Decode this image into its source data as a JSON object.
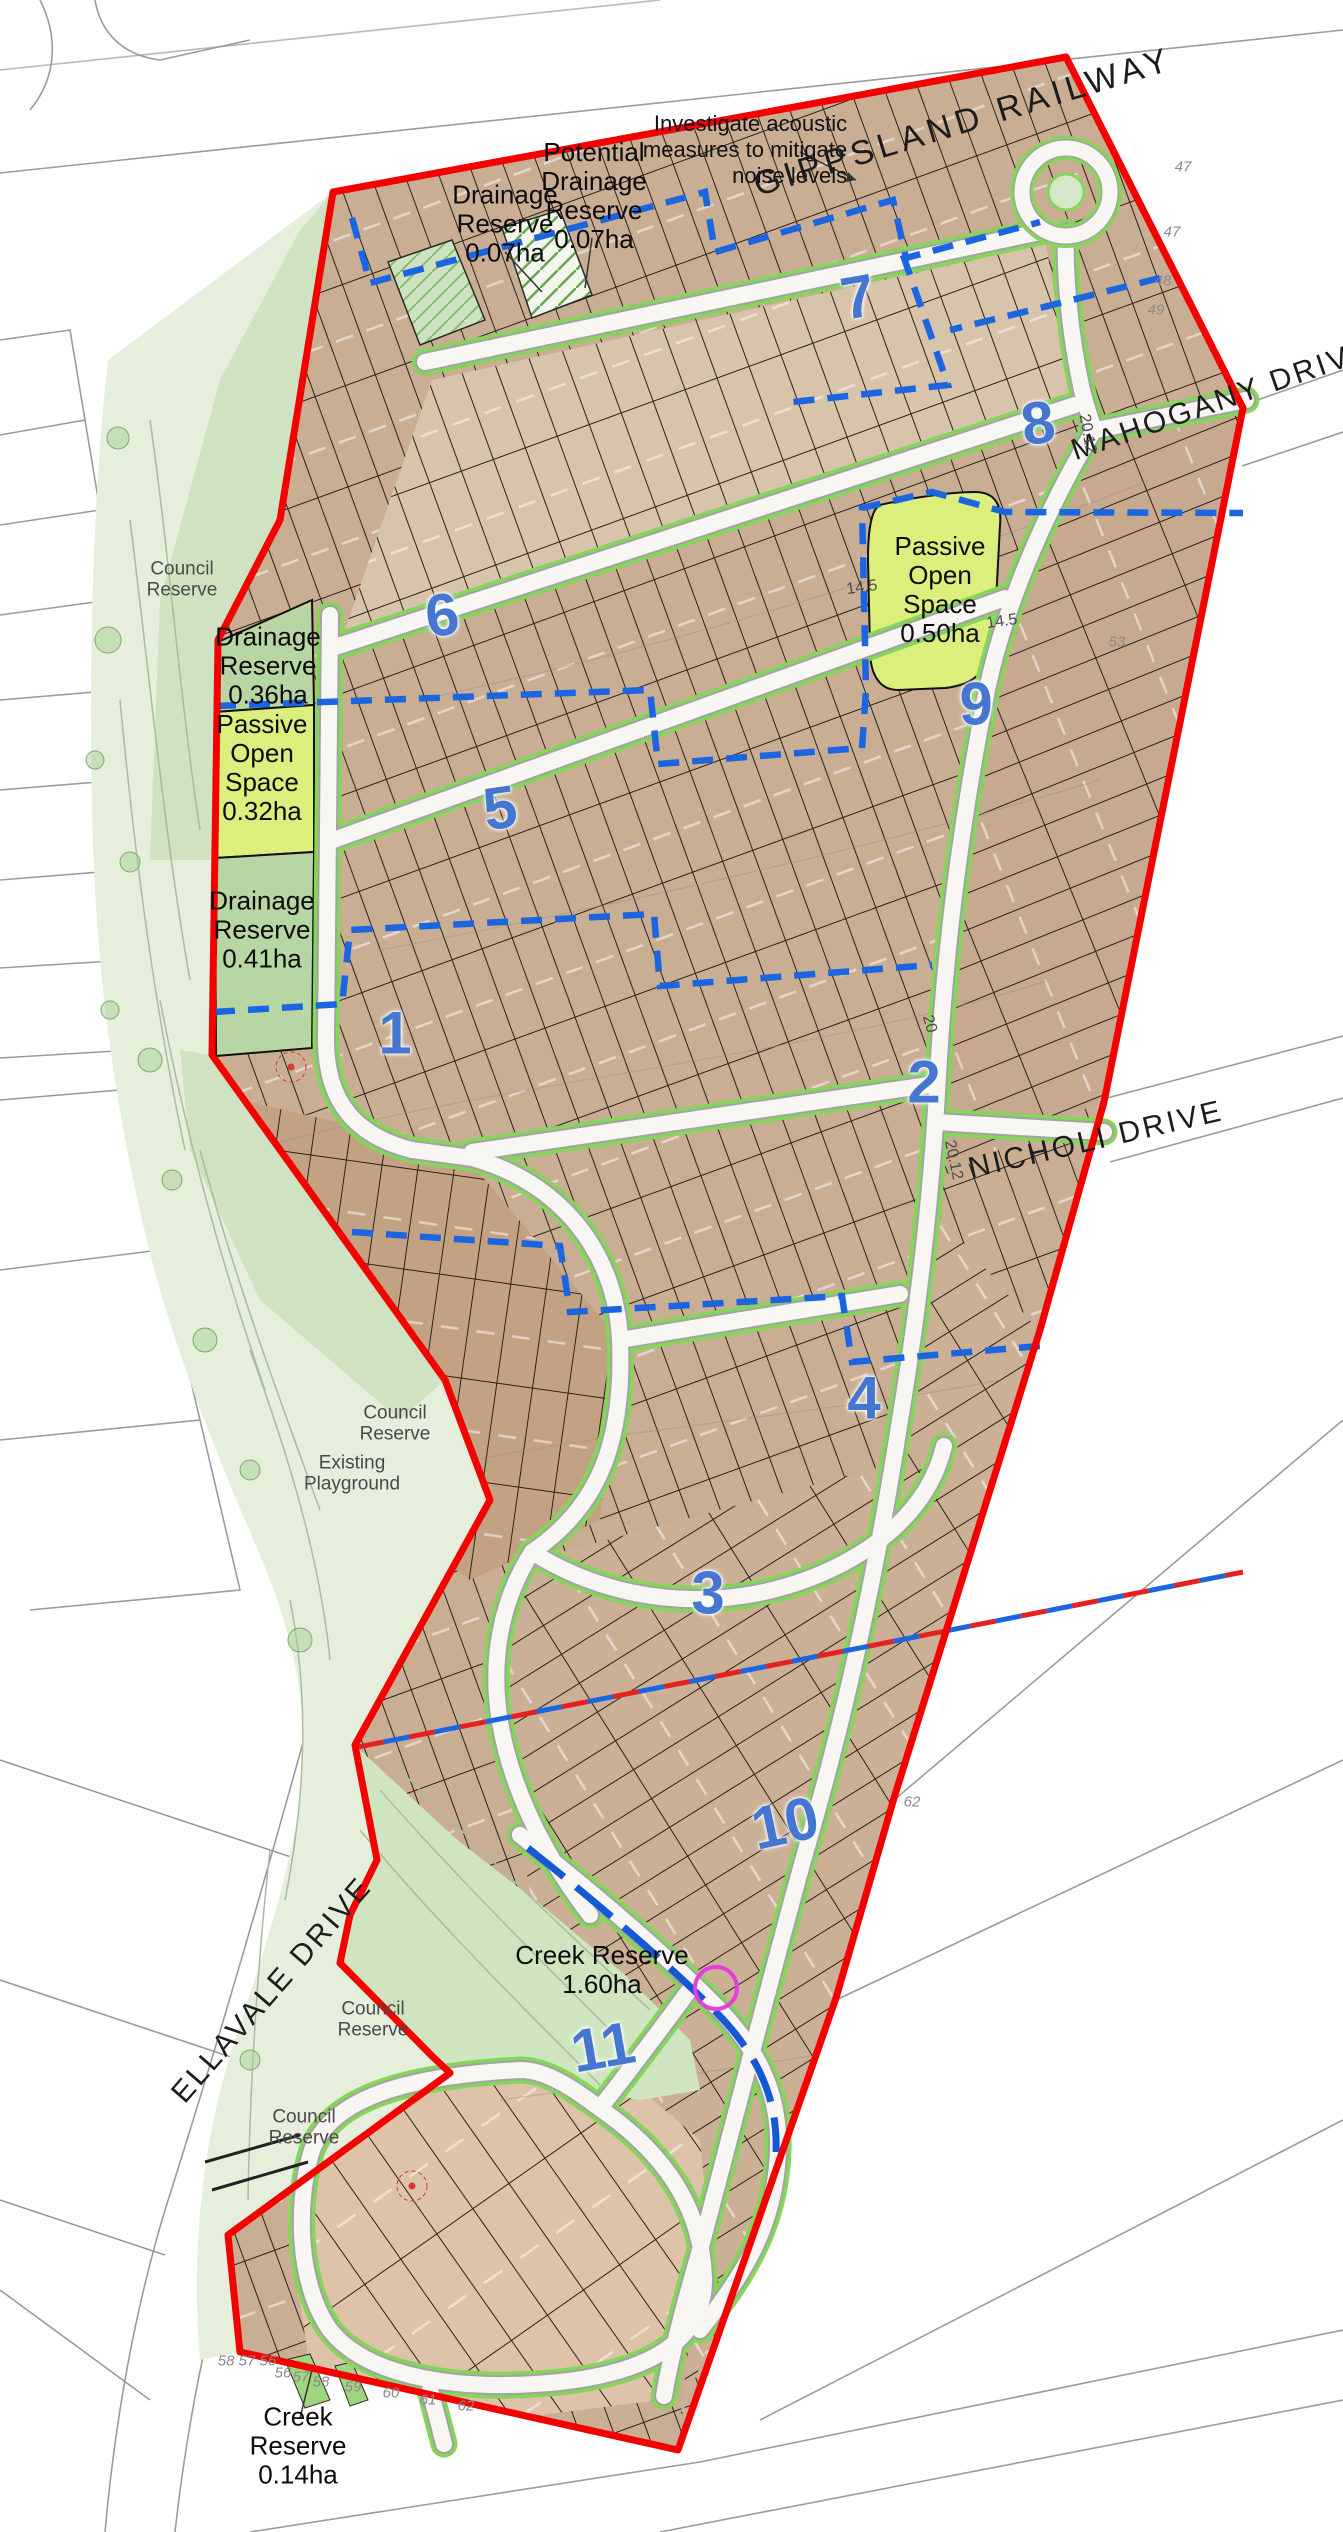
{
  "map": {
    "streets": {
      "gippsland_railway": "GIPPSLAND RAILWAY",
      "mahogany_drive": "MAHOGANY DRIVE",
      "nicholi_drive": "NICHOLI DRIVE",
      "ellavale_drive": "ELLAVALE DRIVE"
    },
    "annotations": {
      "acoustic_note": "Investigate acoustic\nmeasures to mitigate\nnoise levels"
    },
    "reserves": {
      "drainage_007": "Drainage\nReserve\n0.07ha",
      "potential_drainage_007": "Potential\nDrainage\nReserve\n0.07ha",
      "drainage_036": "Drainage\nReserve\n0.36ha",
      "passive_open_space_032": "Passive\nOpen\nSpace\n0.32ha",
      "drainage_041": "Drainage\nReserve\n0.41ha",
      "passive_open_space_050": "Passive\nOpen\nSpace\n0.50ha",
      "creek_160": "Creek Reserve\n1.60ha",
      "creek_014": "Creek\nReserve\n0.14ha",
      "council_nw": "Council\nReserve",
      "council_mid": "Council\nReserve",
      "existing_playground": "Existing\nPlayground",
      "council_ellavale": "Council\nReserve",
      "council_sw": "Council\nReserve"
    },
    "stages": {
      "s1": "1",
      "s2": "2",
      "s3": "3",
      "s4": "4",
      "s5": "5",
      "s6": "6",
      "s7": "7",
      "s8": "8",
      "s9": "9",
      "s10": "10",
      "s11": "11"
    },
    "survey_marks": {
      "m47a": "47",
      "m47b": "47",
      "m48": "48",
      "m49": "49",
      "m53": "53",
      "m62_right": "62",
      "cluster": "58 57 56",
      "m56": "56",
      "m57": "57",
      "m58": "58",
      "m59": "59",
      "m60": "60",
      "m61": "61",
      "m62_bottom": "62"
    },
    "dimensions": {
      "d145a": "14.5",
      "d145b": "14.5",
      "d2012a": "20.12",
      "d2012b": "20.12",
      "d20": "20"
    },
    "colors": {
      "boundary_red": "#f40000",
      "drainage_blue": "#1b66e0",
      "stage_blue": "#4577d0",
      "open_space_green": "#dcee7b",
      "reserve_green": "#b7d6a4",
      "verge_green": "#84d659",
      "lot_tan": "#c9ae94"
    }
  }
}
